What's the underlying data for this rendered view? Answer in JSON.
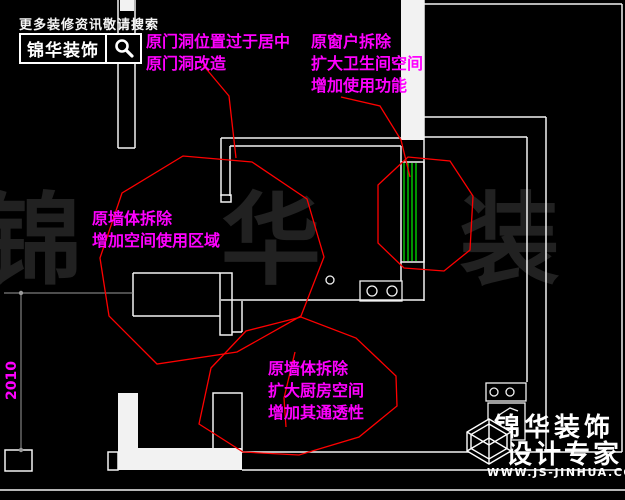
{
  "colors": {
    "background": "#000000",
    "wall_line": "#f2f2f2",
    "revision_cloud": "#ff0000",
    "window_glass": "#00c300",
    "annotation": "#ff00ff",
    "dimension_line": "#9a9a9a",
    "watermark": "#212121"
  },
  "header": {
    "tagline": "更多装修资讯敬请搜索",
    "brand": "锦华装饰",
    "icon": "search-icon"
  },
  "annotations": {
    "door": {
      "lines": [
        "原门洞位置过于居中",
        "原门洞改造"
      ]
    },
    "bathroom": {
      "lines": [
        "原窗户拆除",
        "扩大卫生间空间",
        "增加使用功能"
      ]
    },
    "wall": {
      "lines": [
        "原墙体拆除",
        "增加空间使用区域"
      ]
    },
    "kitchen": {
      "lines": [
        "原墙体拆除",
        "扩大厨房空间",
        "增加其通透性"
      ]
    }
  },
  "dimension": {
    "value": "2010"
  },
  "watermark": {
    "text": "锦 华 装 饰"
  },
  "footer": {
    "brand": "锦华装饰",
    "subtitle": "设计专家",
    "url": "WWW.JS-JINHUA.COM",
    "icon": "cube-logo"
  }
}
